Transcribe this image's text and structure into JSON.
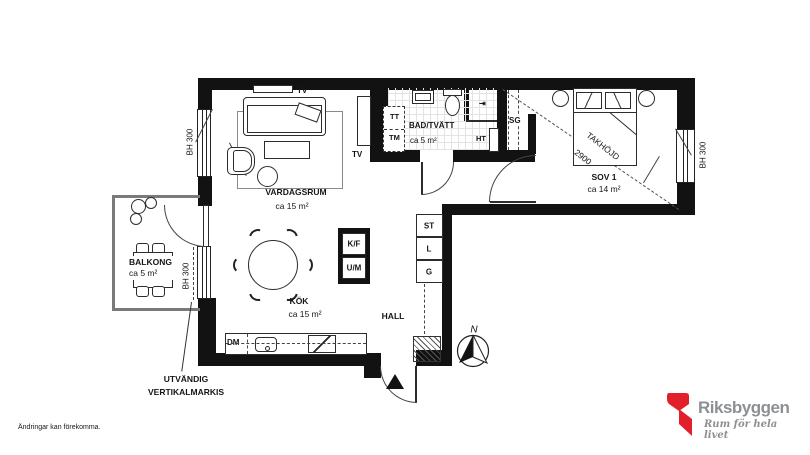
{
  "plan": {
    "rooms": {
      "balkong": {
        "name": "BALKONG",
        "area": "ca 5 m²"
      },
      "vardagsrum": {
        "name": "VARDAGSRUM",
        "area": "ca 15 m²"
      },
      "kok": {
        "name": "KÖK",
        "area": "ca 15 m²"
      },
      "hall": {
        "name": "HALL"
      },
      "bad": {
        "name": "BAD/TVÄTT",
        "area": "ca 5 m²"
      },
      "sov": {
        "name": "SOV 1",
        "area": "ca 14 m²"
      }
    },
    "labels": {
      "tv": "TV",
      "tt": "TT",
      "tm": "TM",
      "ht": "HT",
      "sg": "SG",
      "dm": "DM",
      "kf": "K/F",
      "um": "U/M",
      "st": "ST",
      "l": "L",
      "g": "G",
      "bh300": "BH 300",
      "takhojd": "TAKHÖJD",
      "takhojd_value": "2900"
    },
    "annotations": {
      "markis_line1": "UTVÄNDIG",
      "markis_line2": "VERTIKALMARKIS",
      "disclaimer": "Ändringar kan förekomma.",
      "compass_n": "N"
    },
    "logo": {
      "name": "Riksbyggen",
      "tagline": "Rum för hela livet",
      "red": "#e2202c",
      "gray": "#8d9093"
    }
  }
}
